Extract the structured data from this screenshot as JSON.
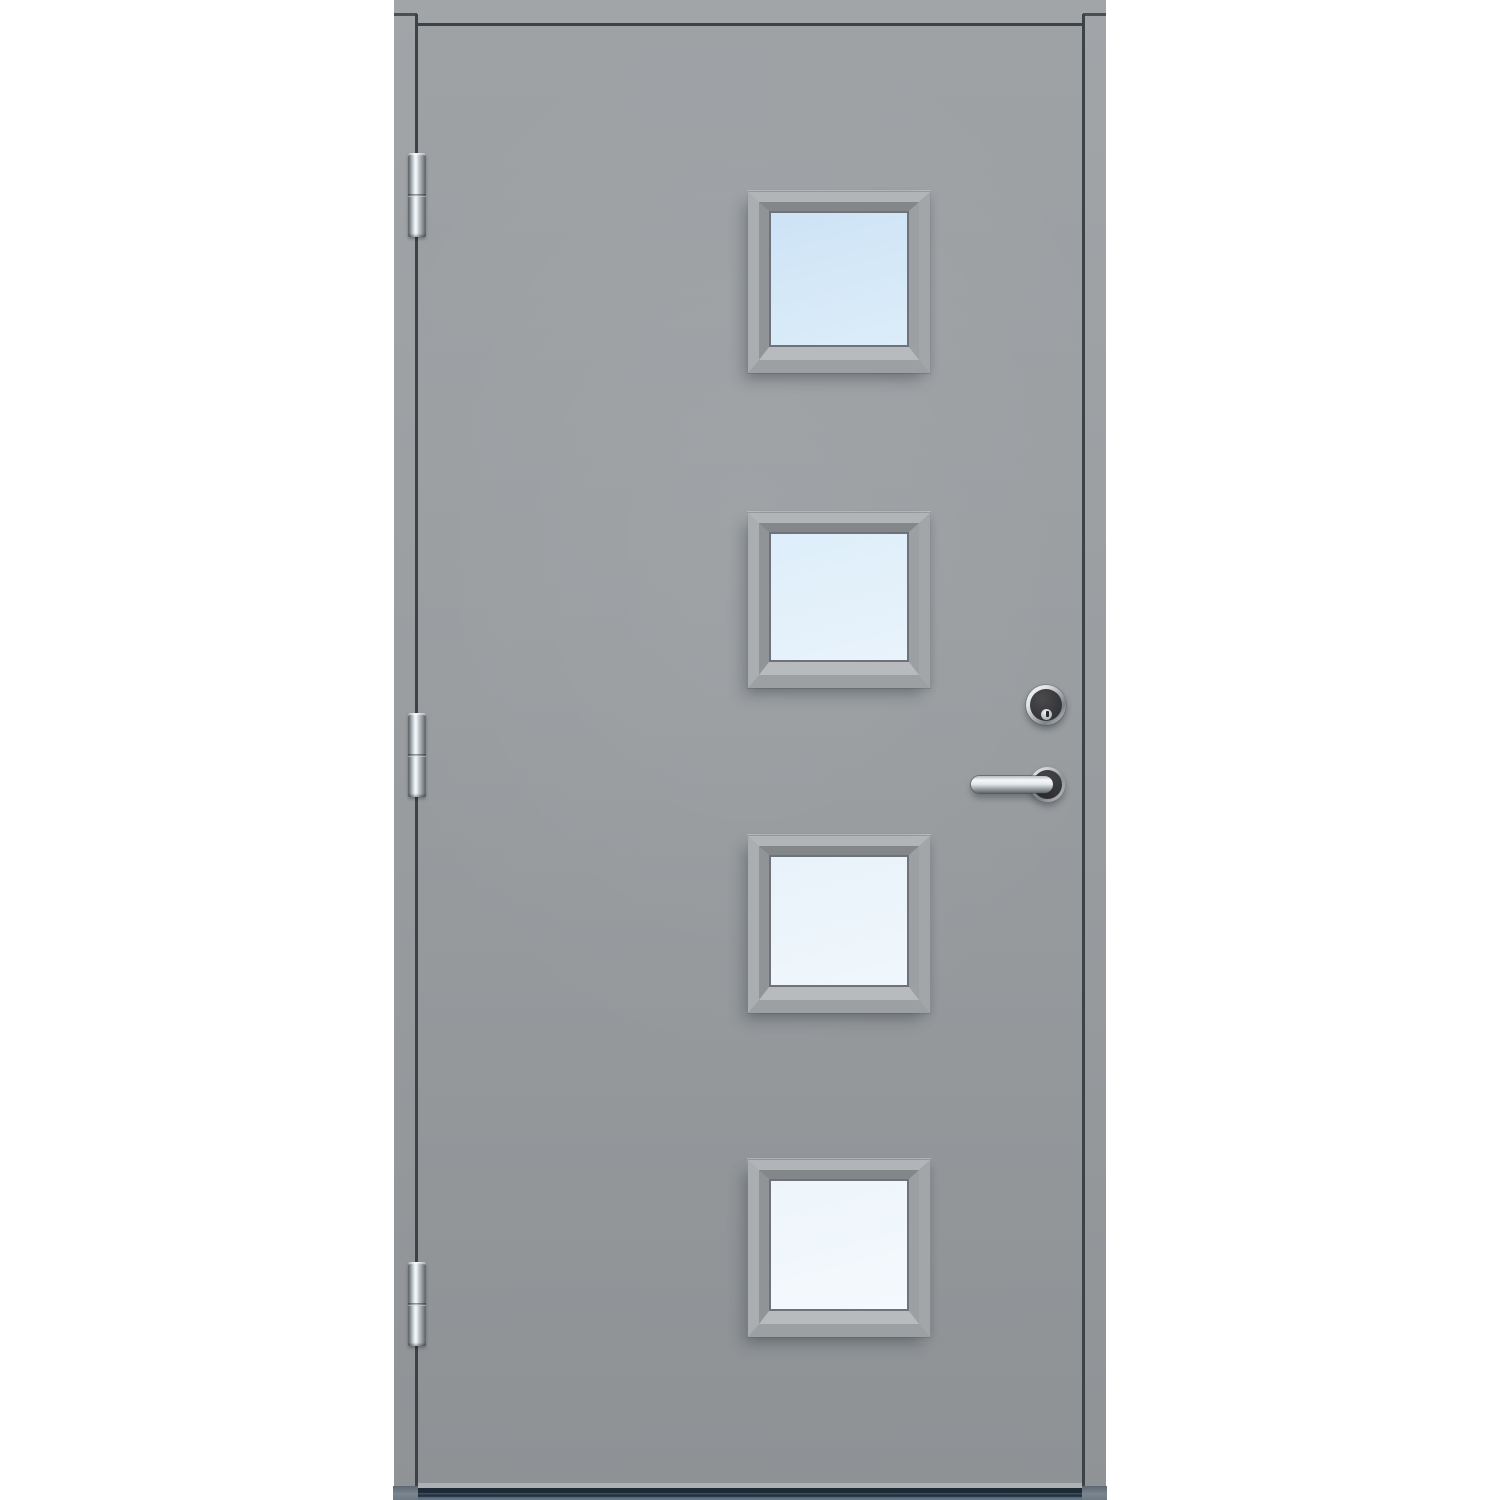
{
  "meta": {
    "type": "product-photo",
    "subject": "Grey exterior front door with four square glass panes, three chrome hinges, cylinder deadbolt lock and chrome lever handle, dark threshold sill",
    "hinge_side": "left",
    "handle_side": "right",
    "window_count": 4,
    "hinge_count": 3
  },
  "colors": {
    "background": "#ffffff",
    "frame_top": "#a1a5a8",
    "frame_bottom": "#8f9396",
    "leaf_top": "#9ea2a5",
    "leaf_mid": "#999da0",
    "leaf_bottom": "#8e9295",
    "gap": "#3d4247",
    "joint": "#4a4f53",
    "window_face_top": "#b2b5b8",
    "window_face_right": "#a3a6a9",
    "window_face_bottom": "#9da0a3",
    "window_face_left": "#abaeb1",
    "bevel_top": "#84878a",
    "bevel_right": "#9da0a3",
    "bevel_bottom": "#b8bbbe",
    "bevel_left": "#919497",
    "glass_ring": "#6f727a",
    "chrome_light": "#f6f9fb",
    "chrome_mid": "#8d9499",
    "chrome_dark": "#565c62",
    "hardware_face": "#39393b",
    "keyway": "#28282a",
    "bottom_edge": "#aeb2b5",
    "threshold_dark": "#1e2a36",
    "threshold_mid": "#425468",
    "threshold_light": "#66788a",
    "foot": "#7a858f"
  },
  "door": {
    "frame": {
      "label": "door-frame"
    },
    "leaf": {
      "label": "door-leaf"
    },
    "windows": [
      {
        "label": "window-1",
        "glass_top": "#cde3f6",
        "glass_bottom": "#dcedf9"
      },
      {
        "label": "window-2",
        "glass_top": "#ddeefa",
        "glass_bottom": "#e9f3fb"
      },
      {
        "label": "window-3",
        "glass_top": "#e8f2fa",
        "glass_bottom": "#f0f7fc"
      },
      {
        "label": "window-4",
        "glass_top": "#edf5fb",
        "glass_bottom": "#f4f9fd"
      }
    ],
    "hinges": [
      {
        "label": "hinge-top"
      },
      {
        "label": "hinge-middle"
      },
      {
        "label": "hinge-bottom"
      }
    ],
    "hardware": [
      {
        "label": "lock-cylinder"
      },
      {
        "label": "handle-rosette"
      },
      {
        "label": "handle-lever"
      }
    ],
    "threshold": {
      "label": "threshold-sill"
    }
  }
}
